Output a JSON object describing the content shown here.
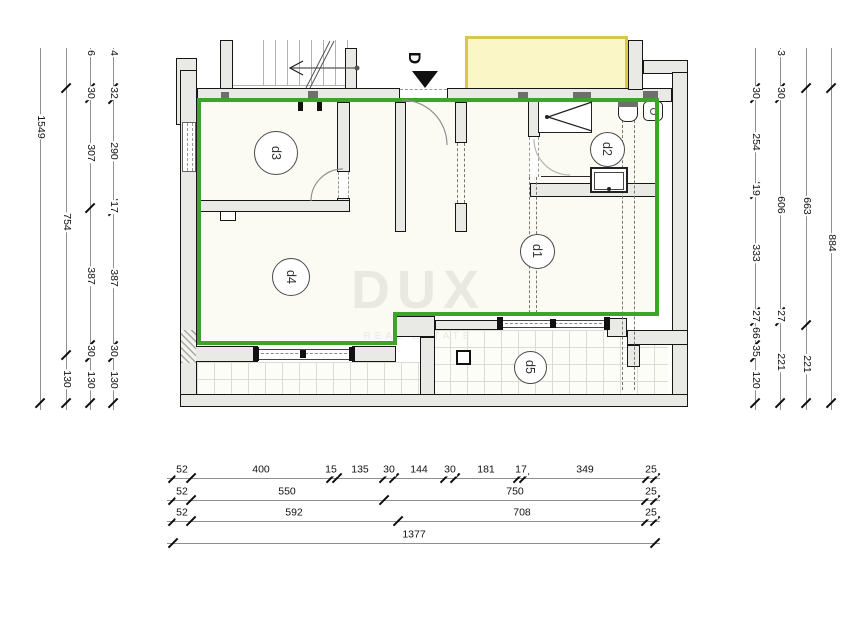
{
  "watermark": {
    "title": "DUX",
    "subtitle": "REAL ESTATE"
  },
  "entrance": {
    "label": "D"
  },
  "colors": {
    "boundary_green": "#3aa526",
    "yellow_fill": "#fbf6c6",
    "yellow_border": "#d9c74b",
    "wall_fill": "#e9e9e5",
    "outline": "#161616",
    "tile_line": "#dcdcd6",
    "watermark": "#e9e9e2"
  },
  "rooms": [
    {
      "label": "d3",
      "cx": 275,
      "cy": 152,
      "d": 42
    },
    {
      "label": "d2",
      "cx": 606,
      "cy": 148,
      "d": 33
    },
    {
      "label": "d1",
      "cx": 536,
      "cy": 250,
      "d": 33
    },
    {
      "label": "d4",
      "cy": 276,
      "cx": 290,
      "d": 36
    },
    {
      "label": "d5",
      "cx": 529,
      "cy": 366,
      "d": 31
    }
  ],
  "dimension_chains": [
    {
      "axis": "v",
      "pos": 40,
      "from": 48,
      "to": 410,
      "ticks": [
        403
      ],
      "labels": [
        {
          "t": "1549",
          "at": 127
        }
      ]
    },
    {
      "axis": "v",
      "pos": 66,
      "from": 48,
      "to": 410,
      "ticks": [
        88,
        355,
        403
      ],
      "labels": [
        {
          "t": "754",
          "at": 222
        },
        {
          "t": "130",
          "at": 379
        }
      ]
    },
    {
      "axis": "v",
      "pos": 90,
      "from": 48,
      "to": 410,
      "ticks": [
        88,
        98,
        208,
        345,
        357,
        403
      ],
      "labels": [
        {
          "t": "6",
          "at": 53
        },
        {
          "t": "30",
          "at": 93
        },
        {
          "t": "307",
          "at": 153
        },
        {
          "t": "387",
          "at": 276
        },
        {
          "t": "30",
          "at": 351
        },
        {
          "t": "130",
          "at": 380
        }
      ]
    },
    {
      "axis": "v",
      "pos": 113,
      "from": 48,
      "to": 410,
      "ticks": [
        88,
        99,
        204,
        211,
        346,
        357,
        403
      ],
      "labels": [
        {
          "t": "4",
          "at": 53
        },
        {
          "t": "32",
          "at": 93
        },
        {
          "t": "290",
          "at": 151
        },
        {
          "t": "17",
          "at": 207
        },
        {
          "t": "387",
          "at": 278
        },
        {
          "t": "30",
          "at": 351
        },
        {
          "t": "130",
          "at": 380
        }
      ]
    },
    {
      "axis": "v",
      "pos": 755,
      "from": 48,
      "to": 410,
      "ticks": [
        88,
        98,
        187,
        194,
        312,
        321,
        345,
        357,
        403
      ],
      "labels": [
        {
          "t": "30",
          "at": 93
        },
        {
          "t": "254",
          "at": 142
        },
        {
          "t": "19",
          "at": 190
        },
        {
          "t": "333",
          "at": 253
        },
        {
          "t": "27",
          "at": 316
        },
        {
          "t": "66",
          "at": 333
        },
        {
          "t": "35",
          "at": 351
        },
        {
          "t": "120",
          "at": 380
        }
      ]
    },
    {
      "axis": "v",
      "pos": 780,
      "from": 48,
      "to": 410,
      "ticks": [
        88,
        98,
        312,
        321,
        403
      ],
      "labels": [
        {
          "t": "3",
          "at": 53
        },
        {
          "t": "30",
          "at": 93
        },
        {
          "t": "606",
          "at": 205
        },
        {
          "t": "27",
          "at": 316
        },
        {
          "t": "221",
          "at": 362
        }
      ]
    },
    {
      "axis": "v",
      "pos": 806,
      "from": 48,
      "to": 410,
      "ticks": [
        88,
        325,
        403
      ],
      "labels": [
        {
          "t": "663",
          "at": 206
        },
        {
          "t": "221",
          "at": 364
        }
      ]
    },
    {
      "axis": "v",
      "pos": 831,
      "from": 48,
      "to": 410,
      "ticks": [
        88,
        403
      ],
      "labels": [
        {
          "t": "884",
          "at": 243
        }
      ]
    },
    {
      "axis": "h",
      "pos": 478,
      "from": 167,
      "to": 660,
      "ticks": [
        173,
        191,
        331,
        337,
        384,
        394,
        445,
        455,
        518,
        524,
        647,
        655
      ],
      "labels": [
        {
          "t": "52",
          "at": 182
        },
        {
          "t": "400",
          "at": 261
        },
        {
          "t": "15",
          "at": 331
        },
        {
          "t": "135",
          "at": 360
        },
        {
          "t": "30",
          "at": 389
        },
        {
          "t": "144",
          "at": 419
        },
        {
          "t": "30",
          "at": 450
        },
        {
          "t": "181",
          "at": 486
        },
        {
          "t": "17",
          "at": 521
        },
        {
          "t": "349",
          "at": 585
        },
        {
          "t": "25",
          "at": 651
        }
      ]
    },
    {
      "axis": "h",
      "pos": 500,
      "from": 167,
      "to": 660,
      "ticks": [
        173,
        191,
        384,
        646,
        655
      ],
      "labels": [
        {
          "t": "52",
          "at": 182
        },
        {
          "t": "550",
          "at": 287
        },
        {
          "t": "750",
          "at": 515
        },
        {
          "t": "25",
          "at": 651
        }
      ]
    },
    {
      "axis": "h",
      "pos": 521,
      "from": 167,
      "to": 660,
      "ticks": [
        173,
        191,
        398,
        646,
        655
      ],
      "labels": [
        {
          "t": "52",
          "at": 182
        },
        {
          "t": "592",
          "at": 294
        },
        {
          "t": "708",
          "at": 522
        },
        {
          "t": "25",
          "at": 651
        }
      ]
    },
    {
      "axis": "h",
      "pos": 543,
      "from": 167,
      "to": 660,
      "ticks": [
        173,
        655
      ],
      "labels": [
        {
          "t": "1377",
          "at": 414
        }
      ]
    }
  ]
}
